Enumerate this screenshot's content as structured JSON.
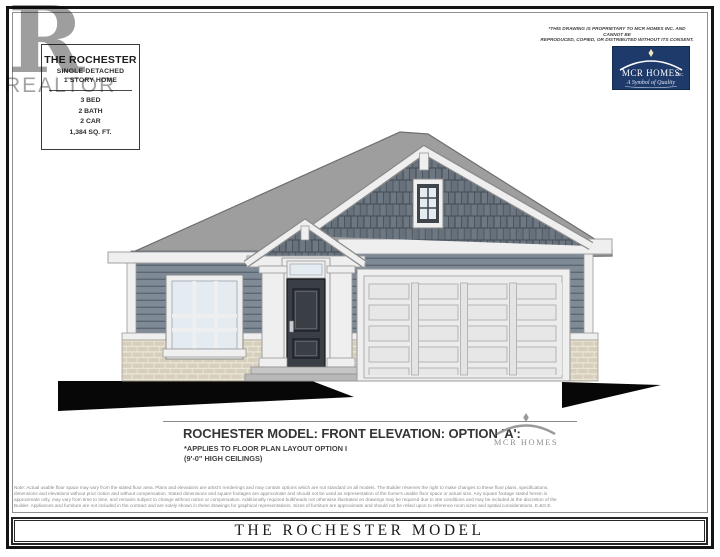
{
  "info_box": {
    "title": "THE ROCHESTER",
    "subtitle1": "SINGLE DETACHED",
    "subtitle2": "1 STORY HOME",
    "specs": [
      "3 BED",
      "2 BATH",
      "2 CAR",
      "1,384 SQ. FT."
    ]
  },
  "watermark": {
    "letter": "R",
    "label": "REALTOR"
  },
  "proprietary_notice": {
    "line1": "*THIS DRAWING IS PROPRIETARY TO MCR HOMES INC. AND CANNOT BE",
    "line2": "REPRODUCED, COPIED, OR DISTRIBUTED WITHOUT ITS CONSENT."
  },
  "builder_logo": {
    "name": "MCR HOMES",
    "suffix": "INC.",
    "tagline": "A Symbol of Quality"
  },
  "caption": {
    "title": "ROCHESTER MODEL: FRONT ELEVATION: OPTION 'A':",
    "note1": "*APPLIES TO FLOOR PLAN LAYOUT OPTION I",
    "note2": "(9'-0\" HIGH CEILINGS)",
    "logo_text": "MCR HOMES"
  },
  "disclaimer": {
    "lines": [
      "Note: Actual usable floor space may vary from the stated floor area. Plans and elevations are artist's renderings and may contain options which are not standard on all models. The Builder reserves the right to make changes to these floor plans, specifications,",
      "dimensions and elevations without prior notice and without compensation. Stated dimensions and square footages are approximate and should not be used as representation of the home's usable floor space or actual size. Any square footage stated herein is",
      "approximate only, may vary from time to time, and remains subject to change without notice or compensation. Additionally required bulkheads not otherwise illustrated on drawings may be required due to site conditions and may be included at the discretion of the",
      "Builder. Appliances and furniture are not included in the contract and are solely shown in these drawings for graphical representations. Sizes of furniture are approximate and should not be relied upon to reference room sizes and spatial considerations. E.&O.E."
    ]
  },
  "footer_bar": {
    "title": "THE ROCHESTER MODEL"
  },
  "colors": {
    "navy": "#1d3a6b",
    "roof": "#9e9e9e",
    "roof_line": "#6e6e6e",
    "shingle": "#6e7883",
    "shingle_alt": "#67717c",
    "shingle_gap": "#49515a",
    "siding": "#7e8a96",
    "siding_line": "#5d6671",
    "trim": "#efefef",
    "trim_line": "#9a9a9a",
    "brick": "#d5cfbc",
    "mortar": "#e9e5d8",
    "door": "#3a3e45",
    "glass": "#e4ecf2",
    "driveway": "#070707"
  }
}
